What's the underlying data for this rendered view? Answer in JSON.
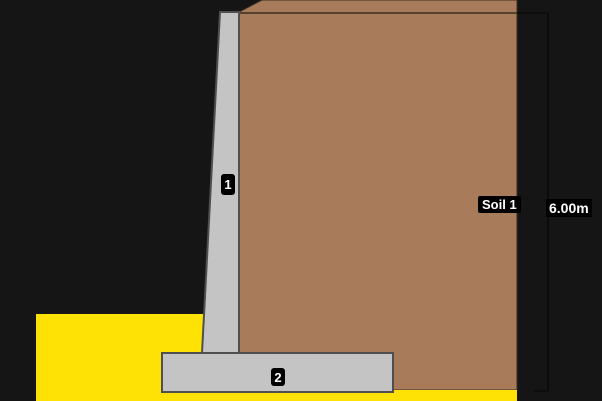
{
  "canvas": {
    "width": 602,
    "height": 401,
    "background": "#151515"
  },
  "labels": {
    "stem": "1",
    "footing": "2",
    "soil": "Soil 1",
    "height_dimension": "6.00m"
  },
  "colors": {
    "backfill_soil": "#a87c5a",
    "soil_edge": "#3a2d20",
    "front_soil": "#ffe205",
    "concrete": "#c4c4c4",
    "concrete_edge": "#4f4f4f",
    "dimension_line": "#0b0b0b",
    "label_background": "#000000",
    "label_text": "#ffffff"
  },
  "shapes": [
    {
      "name": "backfill-soil-body",
      "type": "polygon",
      "points": "239,12 262,0 517,0 517,390 239,390",
      "fill": "#a87c5a",
      "stroke": "#3a2d20",
      "sw": 1,
      "interactable": true
    },
    {
      "name": "soil-surface-line",
      "type": "line",
      "x1": 239,
      "y1": 13,
      "x2": 517,
      "y2": 13,
      "stroke": "#3a2d20",
      "sw": 1.5,
      "interactable": false
    },
    {
      "name": "dimension-top-tick",
      "type": "line",
      "x1": 517,
      "y1": 13,
      "x2": 548,
      "y2": 13,
      "stroke": "#0b0b0b",
      "sw": 1.5,
      "interactable": false
    },
    {
      "name": "dimension-vertical-line",
      "type": "line",
      "x1": 548,
      "y1": 13,
      "x2": 548,
      "y2": 391,
      "stroke": "#0b0b0b",
      "sw": 2,
      "interactable": false
    },
    {
      "name": "dimension-bottom-tick",
      "type": "line",
      "x1": 533,
      "y1": 391,
      "x2": 548,
      "y2": 391,
      "stroke": "#0b0b0b",
      "sw": 1.5,
      "interactable": false
    },
    {
      "name": "foundation-soil-strip",
      "type": "polygon",
      "points": "36,390 517,390 517,401 36,401",
      "fill": "#ffe205",
      "stroke": "none",
      "sw": 0,
      "interactable": true
    },
    {
      "name": "front-terrain-block",
      "type": "polygon",
      "points": "36,314 206,314 206,401 36,401",
      "fill": "#ffe205",
      "stroke": "none",
      "sw": 0,
      "interactable": true
    },
    {
      "name": "wall-footing",
      "type": "polygon",
      "points": "162,353 393,353 393,392 162,392",
      "fill": "#c4c4c4",
      "stroke": "#4f4f4f",
      "sw": 2,
      "interactable": true
    },
    {
      "name": "wall-stem",
      "type": "polygon",
      "points": "220,12 239,12 239,353 202,353",
      "fill": "#c4c4c4",
      "stroke": "#4f4f4f",
      "sw": 2,
      "interactable": true
    }
  ]
}
